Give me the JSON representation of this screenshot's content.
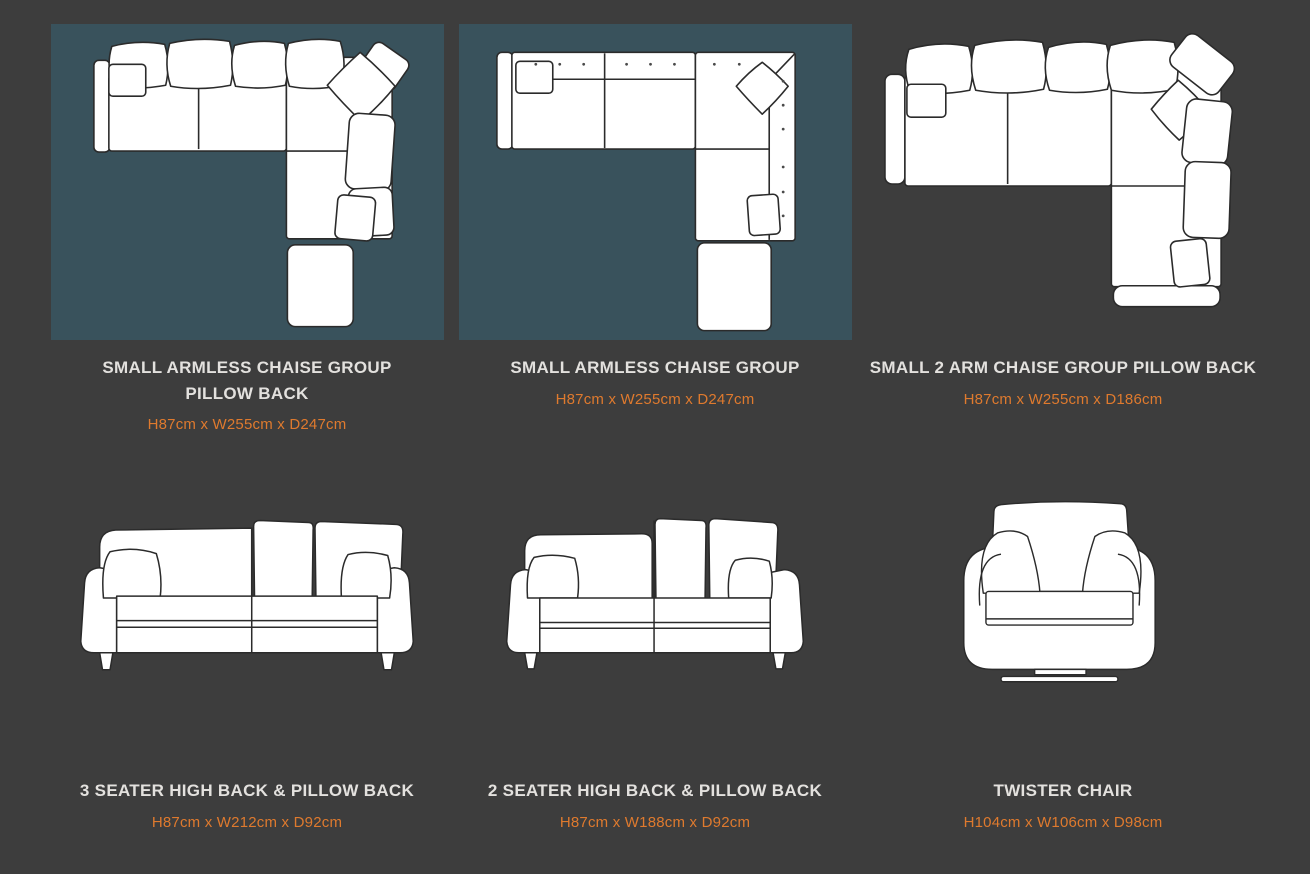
{
  "theme": {
    "page_background": "#3d3d3d",
    "image_panel_background": "#39525c",
    "title_color": "#e3e1de",
    "dimension_color": "#df7a2e",
    "line_art_stroke": "#2b2b2b",
    "line_art_fill": "#ffffff"
  },
  "products": [
    {
      "title": "SMALL ARMLESS CHAISE GROUP PILLOW BACK",
      "dimensions": "H87cm x W255cm x D247cm",
      "illustration": "corner-sofa-top-view-pillow-back",
      "highlighted_panel": true
    },
    {
      "title": "SMALL ARMLESS CHAISE GROUP",
      "dimensions": "H87cm x W255cm x D247cm",
      "illustration": "corner-sofa-top-view-plain-back",
      "highlighted_panel": true
    },
    {
      "title": "SMALL 2 ARM CHAISE GROUP PILLOW BACK",
      "dimensions": "H87cm x W255cm x D186cm",
      "illustration": "corner-sofa-top-view-two-arm-pillow-back",
      "highlighted_panel": false
    },
    {
      "title": "3 SEATER HIGH BACK & PILLOW BACK",
      "dimensions": "H87cm x W212cm x D92cm",
      "illustration": "three-seater-sofa-front-view",
      "highlighted_panel": false
    },
    {
      "title": "2 SEATER HIGH BACK & PILLOW BACK",
      "dimensions": "H87cm x W188cm x D92cm",
      "illustration": "two-seater-sofa-front-view",
      "highlighted_panel": false
    },
    {
      "title": "TWISTER CHAIR",
      "dimensions": "H104cm x W106cm x D98cm",
      "illustration": "twister-chair-front-view",
      "highlighted_panel": false
    }
  ]
}
